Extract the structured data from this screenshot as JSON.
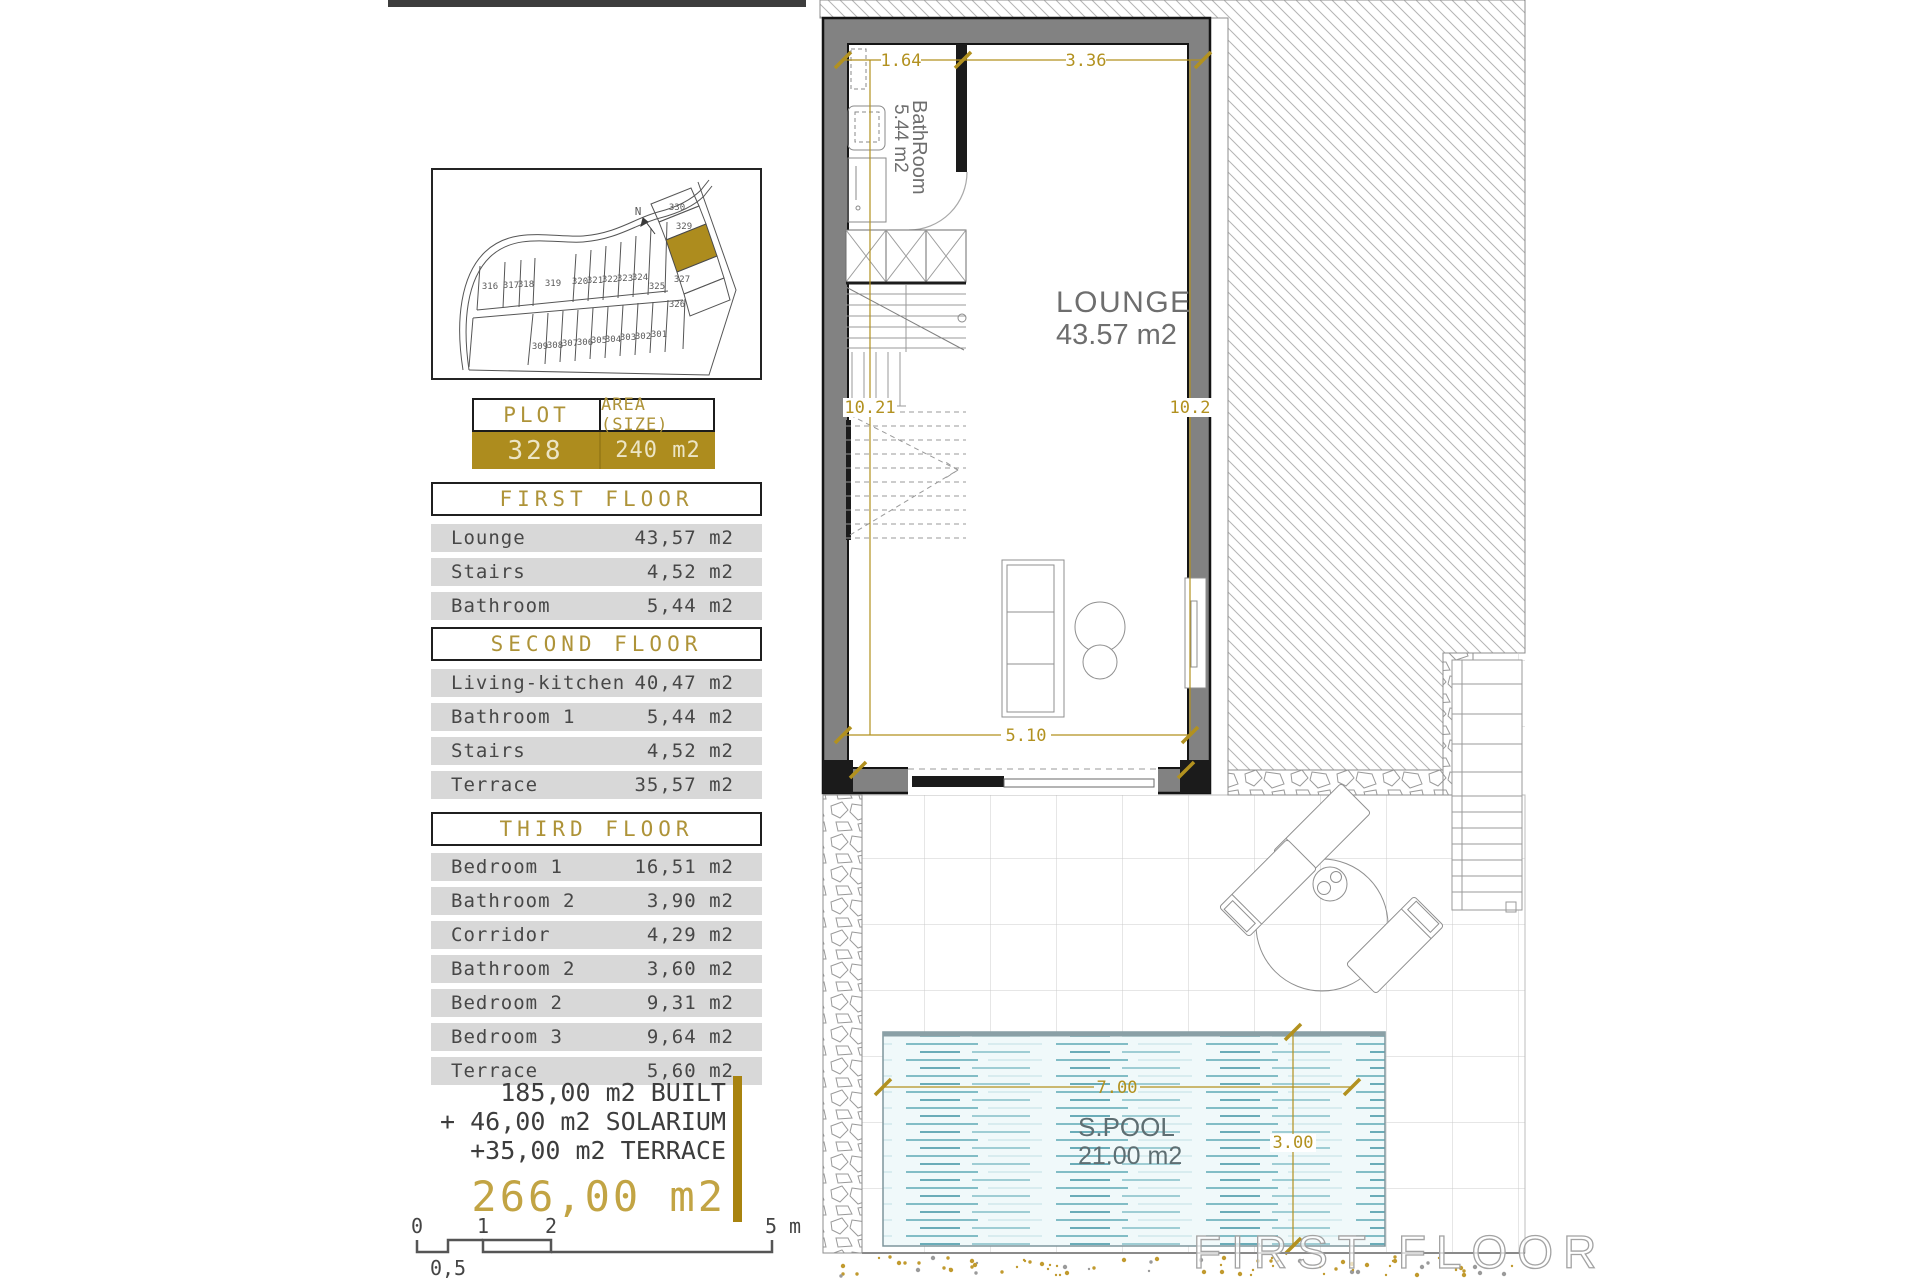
{
  "site_plan": {
    "north_label": "N",
    "plots_top": [
      "316",
      "317",
      "318",
      "319",
      "320",
      "321",
      "322",
      "323",
      "324",
      "325"
    ],
    "plots_bottom": [
      "309",
      "308",
      "307",
      "306",
      "305",
      "304",
      "303",
      "302",
      "301"
    ],
    "plots_right": [
      "330",
      "329",
      "327",
      "326"
    ],
    "highlighted_plot": "328"
  },
  "plot_table": {
    "plot_header": "PLOT",
    "area_header": "AREA (SIZE)",
    "plot_value": "328",
    "area_value": "240 m2"
  },
  "floor_tables": [
    {
      "title": "FIRST FLOOR",
      "rows": [
        {
          "label": "Lounge",
          "area": "43,57 m2"
        },
        {
          "label": "Stairs",
          "area": "4,52 m2"
        },
        {
          "label": "Bathroom",
          "area": "5,44 m2"
        }
      ]
    },
    {
      "title": "SECOND FLOOR",
      "rows": [
        {
          "label": "Living-kitchen",
          "area": "40,47 m2"
        },
        {
          "label": "Bathroom 1",
          "area": "5,44 m2"
        },
        {
          "label": "Stairs",
          "area": "4,52 m2"
        },
        {
          "label": "Terrace",
          "area": "35,57 m2"
        }
      ]
    },
    {
      "title": "THIRD FLOOR",
      "rows": [
        {
          "label": "Bedroom 1",
          "area": "16,51 m2"
        },
        {
          "label": "Bathroom 2",
          "area": "3,90 m2"
        },
        {
          "label": "Corridor",
          "area": "4,29 m2"
        },
        {
          "label": "Bathroom 2",
          "area": "3,60 m2"
        },
        {
          "label": "Bedroom 2",
          "area": "9,31 m2"
        },
        {
          "label": "Bedroom 3",
          "area": "9,64 m2"
        },
        {
          "label": "Terrace",
          "area": "5,60 m2"
        }
      ]
    }
  ],
  "totals": {
    "line1": "185,00 m2 BUILT",
    "line2": "+ 46,00 m2 SOLARIUM",
    "line3": "+35,00 m2 TERRACE",
    "total": "266,00 m2"
  },
  "scale_bar": {
    "tick_0": "0",
    "tick_05": "0,5",
    "tick_1": "1",
    "tick_2": "2",
    "tick_5": "5 m"
  },
  "floor_plan": {
    "lounge_name": "LOUNGE",
    "lounge_area": "43.57 m2",
    "bathroom_name": "BathRoom",
    "bathroom_area": "5.44 m2",
    "pool_name": "S.POOL",
    "pool_area": "21.00 m2",
    "dim_bath_width": "1.64",
    "dim_top_width": "3.36",
    "dim_left_height": "10.21",
    "dim_right_height": "10.2",
    "dim_bottom_width": "5.10",
    "dim_pool_width": "7.00",
    "dim_pool_height": "3.00",
    "watermark": "FIRST FLOOR"
  },
  "colors": {
    "gold": "#ad8c1e",
    "gold_dim": "#b2911f",
    "water": "#4d9fae",
    "wall_gray": "#828282",
    "row_bg": "#d8d8d8"
  }
}
